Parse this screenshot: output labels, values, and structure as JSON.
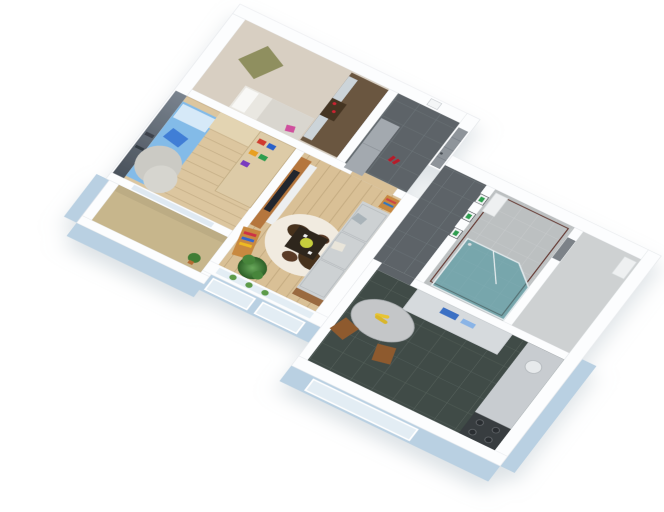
{
  "scene": {
    "description": "3D isometric cutaway render of a small apartment floor plan on a white background",
    "rooms": [
      "master-bedroom",
      "kids-bedroom",
      "living-room",
      "entrance-hall",
      "corridor",
      "bathroom",
      "storage-niche",
      "kitchen",
      "balcony"
    ]
  },
  "palette": {
    "background": "#ffffff",
    "wall_white": "#fcfdfe",
    "wall_edge": "#e6e9ec",
    "exterior_blue": "#b9d0e2",
    "window_glass": "#e3edf4",
    "master_floor": "#d8cfc2",
    "kids_floor": "#dcc69f",
    "living_floor": "#d9c096",
    "balcony_floor": "#c7b68c",
    "hall_tile": "#5d6468",
    "kitchen_tile": "#404b47",
    "bath_floor": "#bcc0c1",
    "wc_floor": "#ced1d2",
    "shower_teal": "#4d96a0",
    "accent_stripe": "#5d2a22",
    "door_gray": "#8e949a",
    "sofa_gray": "#cdd1d3",
    "bed_blue": "#83bbe8",
    "bed_pillow": "#d6e9f8",
    "wardrobe_brown": "#6a5640",
    "wardrobe_doors": "#ccd4d9",
    "tv_unit_wood": "#b5763d",
    "shelf_wood": "#ddcba7",
    "plant_green": "#3f7d35",
    "rug_base": "#f1ebe0",
    "rug_spot": "#46301f",
    "coffee_table": "#2e251e",
    "counter_gray": "#c8ccd0",
    "stove_dark": "#393d40",
    "chair_wood": "#8e5a2d",
    "banana_yellow": "#e7c431",
    "picture_green": "#2f9e50",
    "shoes_red": "#b61c2c",
    "mural_dark": "#5a6571",
    "cabinet_gray": "#a3a9af"
  }
}
